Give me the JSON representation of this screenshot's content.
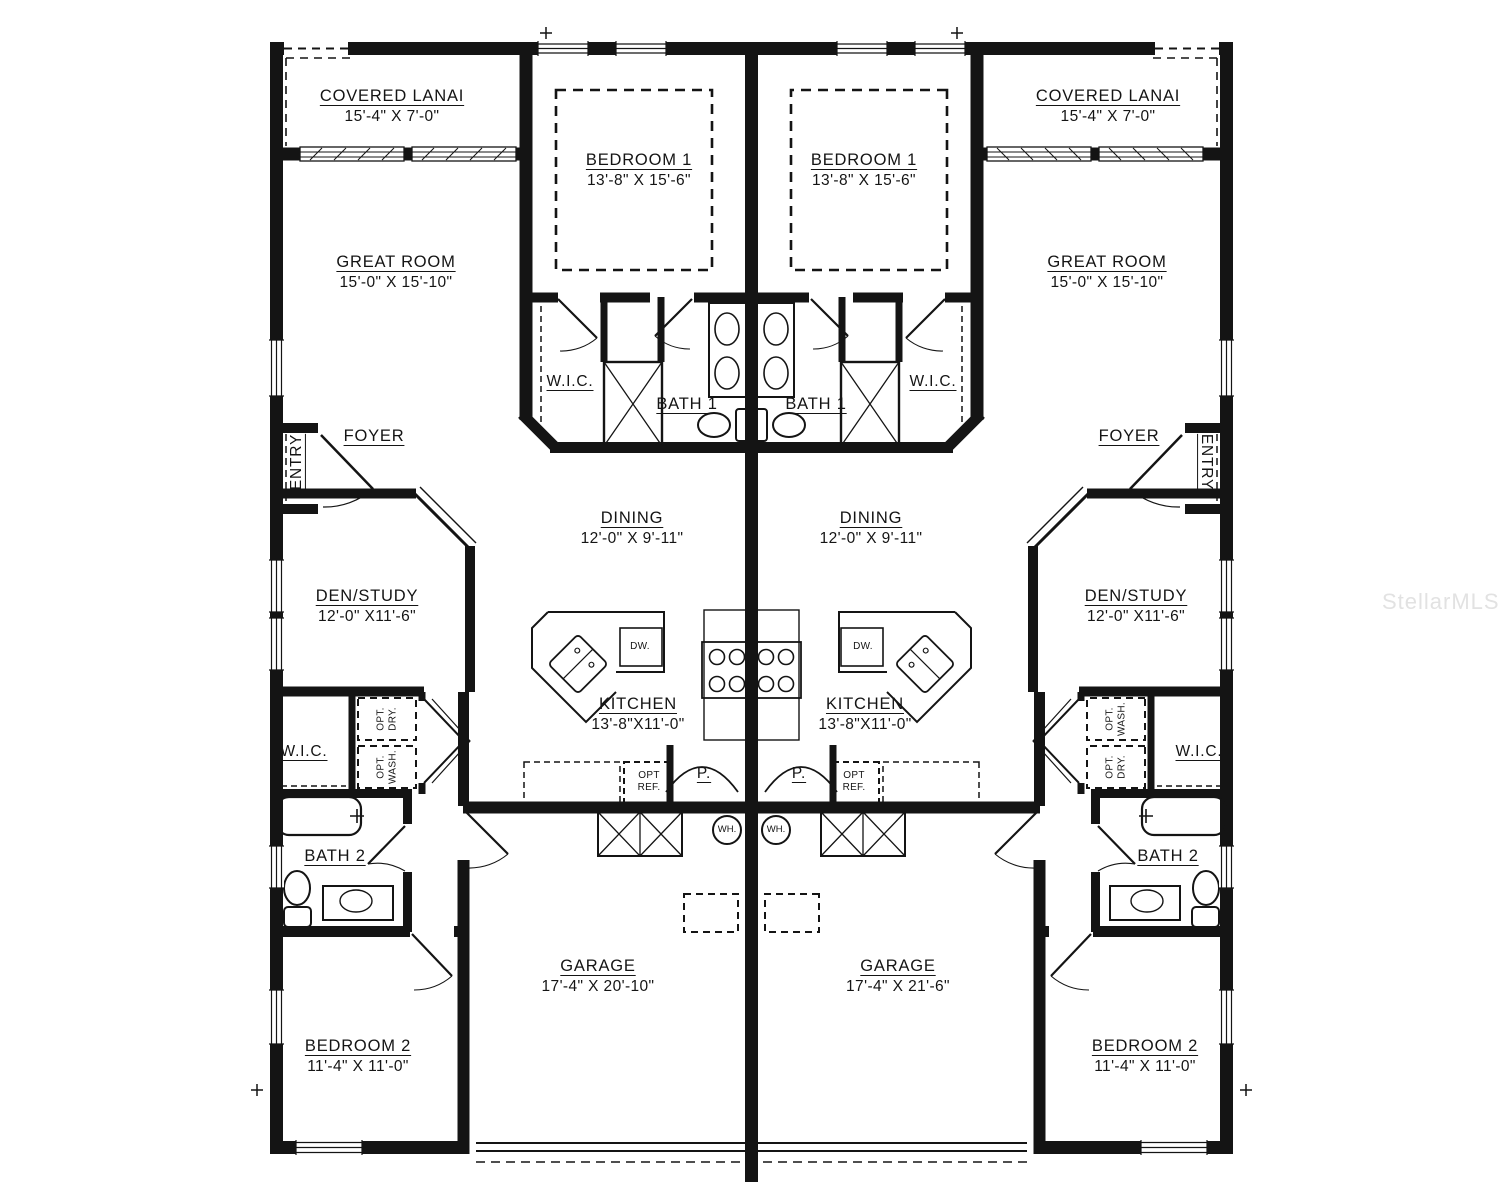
{
  "watermark": "StellarMLS",
  "colors": {
    "wall": "#141414",
    "background": "#ffffff",
    "watermark": "#e2e2e2"
  },
  "rooms": {
    "covered_lanai": {
      "name": "COVERED LANAI",
      "dims": "15'-4\" X 7'-0\""
    },
    "bedroom1": {
      "name": "BEDROOM 1",
      "dims": "13'-8\" X 15'-6\""
    },
    "great_room": {
      "name": "GREAT ROOM",
      "dims": "15'-0\" X 15'-10\""
    },
    "dining": {
      "name": "DINING",
      "dims": "12'-0\" X 9'-11\""
    },
    "den_study": {
      "name": "DEN/STUDY",
      "dims": "12'-0\" X11'-6\""
    },
    "kitchen": {
      "name": "KITCHEN",
      "dims": "13'-8\"X11'-0\""
    },
    "bedroom2": {
      "name": "BEDROOM 2",
      "dims": "11'-4\" X 11'-0\""
    },
    "bath1": "BATH 1",
    "bath2": "BATH 2",
    "wic": "W.I.C.",
    "foyer": "FOYER",
    "entry": "ENTRY",
    "pantry": "P."
  },
  "fixtures": {
    "dishwasher": "DW.",
    "water_heater": "WH.",
    "opt_ref": [
      "OPT",
      "REF."
    ]
  },
  "units": {
    "left": {
      "garage": {
        "name": "GARAGE",
        "dims": "17'-4\" X 20'-10\""
      },
      "laundry_top": [
        "OPT.",
        "DRY."
      ],
      "laundry_bottom": [
        "OPT.",
        "WASH."
      ]
    },
    "right": {
      "garage": {
        "name": "GARAGE",
        "dims": "17'-4\" X 21'-6\""
      },
      "laundry_top": [
        "OPT.",
        "WASH."
      ],
      "laundry_bottom": [
        "OPT.",
        "DRY."
      ]
    }
  }
}
